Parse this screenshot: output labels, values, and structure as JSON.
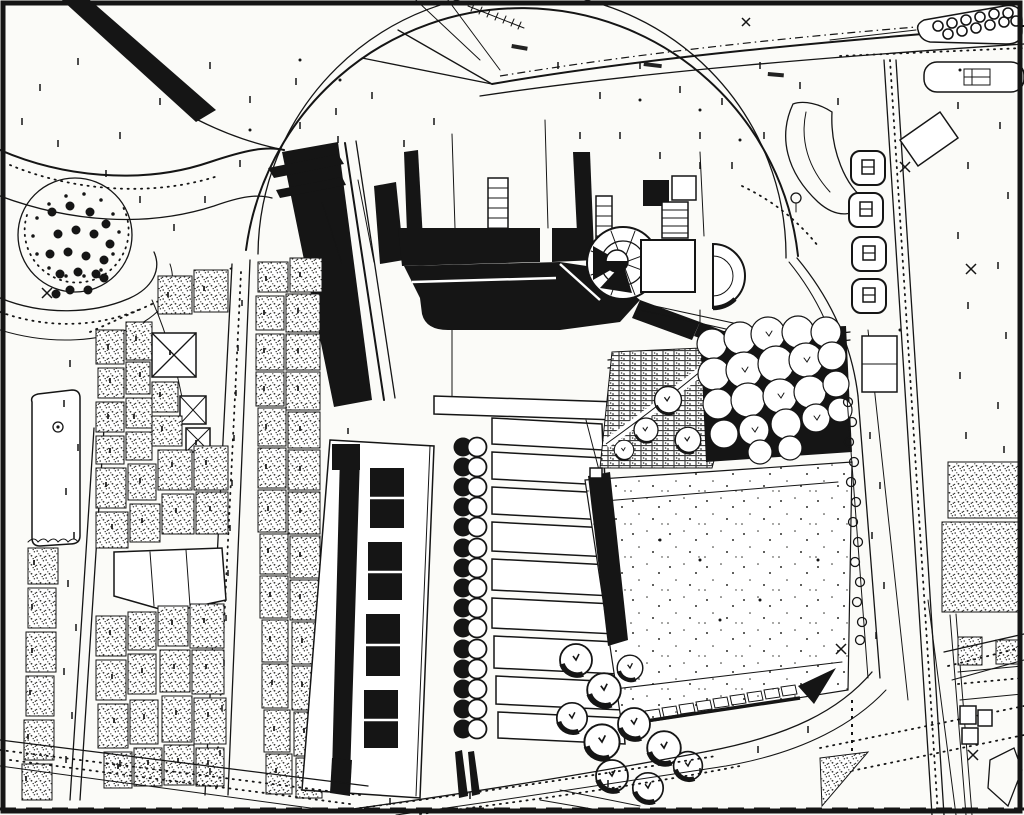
{
  "figure": {
    "kind": "Scanned black-and-white architectural site plan",
    "aria_label": "Scanned black-and-white architectural site plan of an urban district with a large arched building complex, tilted plaza, tree clusters, dense old-town fabric and surrounding boulevards",
    "width_px": 1024,
    "height_px": 815
  },
  "palette": {
    "paper": "#fbfbf8",
    "ink": "#151515",
    "halftone_gray": "#9a9a92"
  },
  "counts": {
    "colonnade_column_pairs": 15,
    "terrace_rows": 9,
    "roundabout_tree_dots": 19,
    "planter_boxes": 4
  },
  "features": {
    "frame_border": "scan border frame",
    "bridge_viaduct": "black diagonal bridge and viaduct band",
    "roundabout_grove": "circular tree grove in traffic loop",
    "west_urban_fabric": "dense hatched old-town building blocks",
    "entrance_arc": "large semicircular entrance arc",
    "black_hall_mass": "black poché main hall building",
    "rotunda": "circular rotunda with radial spokes",
    "apse_annex": "semicircular apse annex",
    "west_wing_building": "long wing with black room blocks",
    "colonnade": "double row of round columns",
    "terrace_steps": "stepped terrace strips",
    "brick_court": "brick-hatched garden court",
    "ne_tree_cluster": "dense tree canopy cluster",
    "tilted_plaza": "large tilted speckled plaza",
    "sw_tree_cluster": "bold tree canopies south-west of plaza",
    "east_boulevard": "multi-lane boulevard with dotted lanes",
    "traffic_islands": "rounded traffic islands with tree rows",
    "planter_row": "row of square tree planters",
    "east_fields": "hatched parcels east of boulevard",
    "survey_marks": "scattered surveyor tick and cross marks",
    "microtext": "illegible micro labels from scan"
  }
}
